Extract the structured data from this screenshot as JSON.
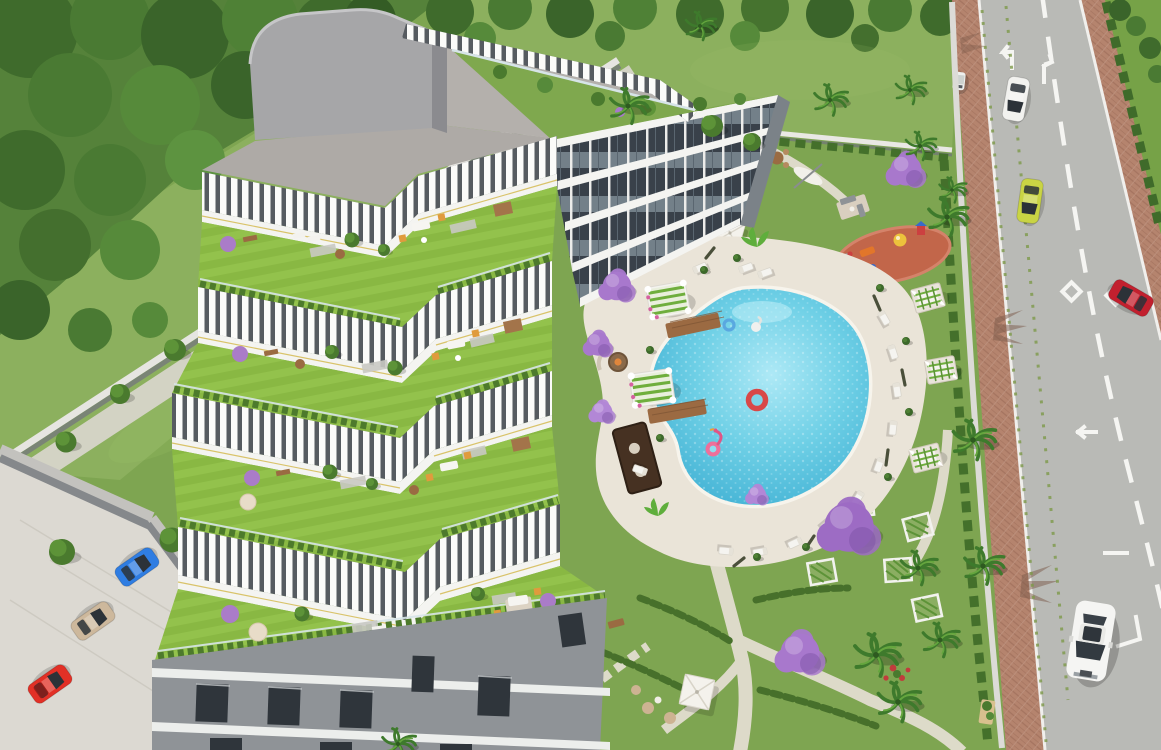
{
  "scene": {
    "type": "3d-architectural-aerial-render",
    "description": "High-angle aerial rendering of a modern terraced apartment complex with cascading white louvered pergola terraces and rooftop gardens, a landscaped courtyard with free-form swimming pool, cabanas, daybeds, playground and flowering jacaranda trees, bordered on the left by woodland and a perimeter wall with parked cars, and on the right by a two-lane road with brick-paved sidewalks and passing cars."
  },
  "palette": {
    "grass_base": "#7ea551",
    "meadow": "#8cb05e",
    "forest_dark": "#3f6b2c",
    "road": "#b9bab6",
    "sidewalk": "#b5846e",
    "marking": "#f5f5f2",
    "pool_light": "#8fdcef",
    "pool_deep": "#3fb2d6",
    "deck": "#eae4d8",
    "building_white": "#f4f4f1",
    "louver_shadow": "#565b60",
    "facade_glass": "#39414a",
    "roof_gray": "#b4b0ac",
    "lower_facade": "#8f9397",
    "jacaranda": "#a878cc",
    "playground": "#c2664a",
    "path": "#e3ddd0",
    "wall_light": "#e6e5e1"
  },
  "building": {
    "style": "stepped residential block, terraces descending to the south-west",
    "terrace_levels": 4,
    "facade_floors": 4,
    "roof": "flat gray roof with rounded penthouse volume",
    "terrace_features": [
      "lawns",
      "hedges",
      "small trees",
      "purple shrubs",
      "white sofas",
      "orange armchairs",
      "wooden dining sets",
      "sun loungers",
      "round daybeds",
      "wooden pergolas"
    ]
  },
  "pool": {
    "shape": "freeform kidney",
    "floats": [
      {
        "type": "flamingo",
        "color": "#ee6f9a"
      },
      {
        "type": "ring-large",
        "color": "#d84848"
      },
      {
        "type": "ring-small",
        "color": "#5aa8e0"
      },
      {
        "type": "swan",
        "color": "#f0f0ee"
      }
    ],
    "cabanas": 2,
    "daybeds": 3,
    "sun_loungers": "about 14 around the deck",
    "features": [
      "outdoor cinema screen",
      "fire-pit lounge",
      "wooden swim decks",
      "closed parasols",
      "potted plants",
      "open white parasol"
    ]
  },
  "playground": {
    "surface_color": "#c2664a",
    "equipment_colors": [
      "#ecc23c",
      "#e2762a",
      "#cc4040",
      "#3a6bc8"
    ]
  },
  "road": {
    "lanes": 2,
    "markings": [
      "dashed center line",
      "turn arrows",
      "diamond symbols",
      "lane bars"
    ],
    "vehicles": [
      {
        "type": "car-northbound-top",
        "color": "#f2f2ef"
      },
      {
        "type": "car-southbound-mid",
        "color": "#c9d444"
      },
      {
        "type": "car-northbound-right",
        "color": "#c2202e"
      },
      {
        "type": "sedan-southbound-bottom",
        "color": "#f5f5f3"
      },
      {
        "type": "golf-cart-sidewalk",
        "color": "#eef0ee"
      }
    ]
  },
  "parking": {
    "vehicles": [
      {
        "type": "hatchback",
        "color": "#2f7de2"
      },
      {
        "type": "sedan",
        "color": "#cdb89c"
      },
      {
        "type": "sports-car",
        "color": "#e23026"
      }
    ]
  },
  "vegetation": {
    "jacaranda_color": "#a878cc",
    "jacaranda_count": 7,
    "palm_count": 13,
    "ball_trees_along_wall": 6,
    "woodland": "dense mixed trees upper-left and along the top edge"
  },
  "walls": {
    "left_perimeter": "low white wall with ball-shaped trees",
    "road_side": "light wall with palms casting shadows on the brick sidewalk",
    "north": "white garden wall with hedge"
  }
}
